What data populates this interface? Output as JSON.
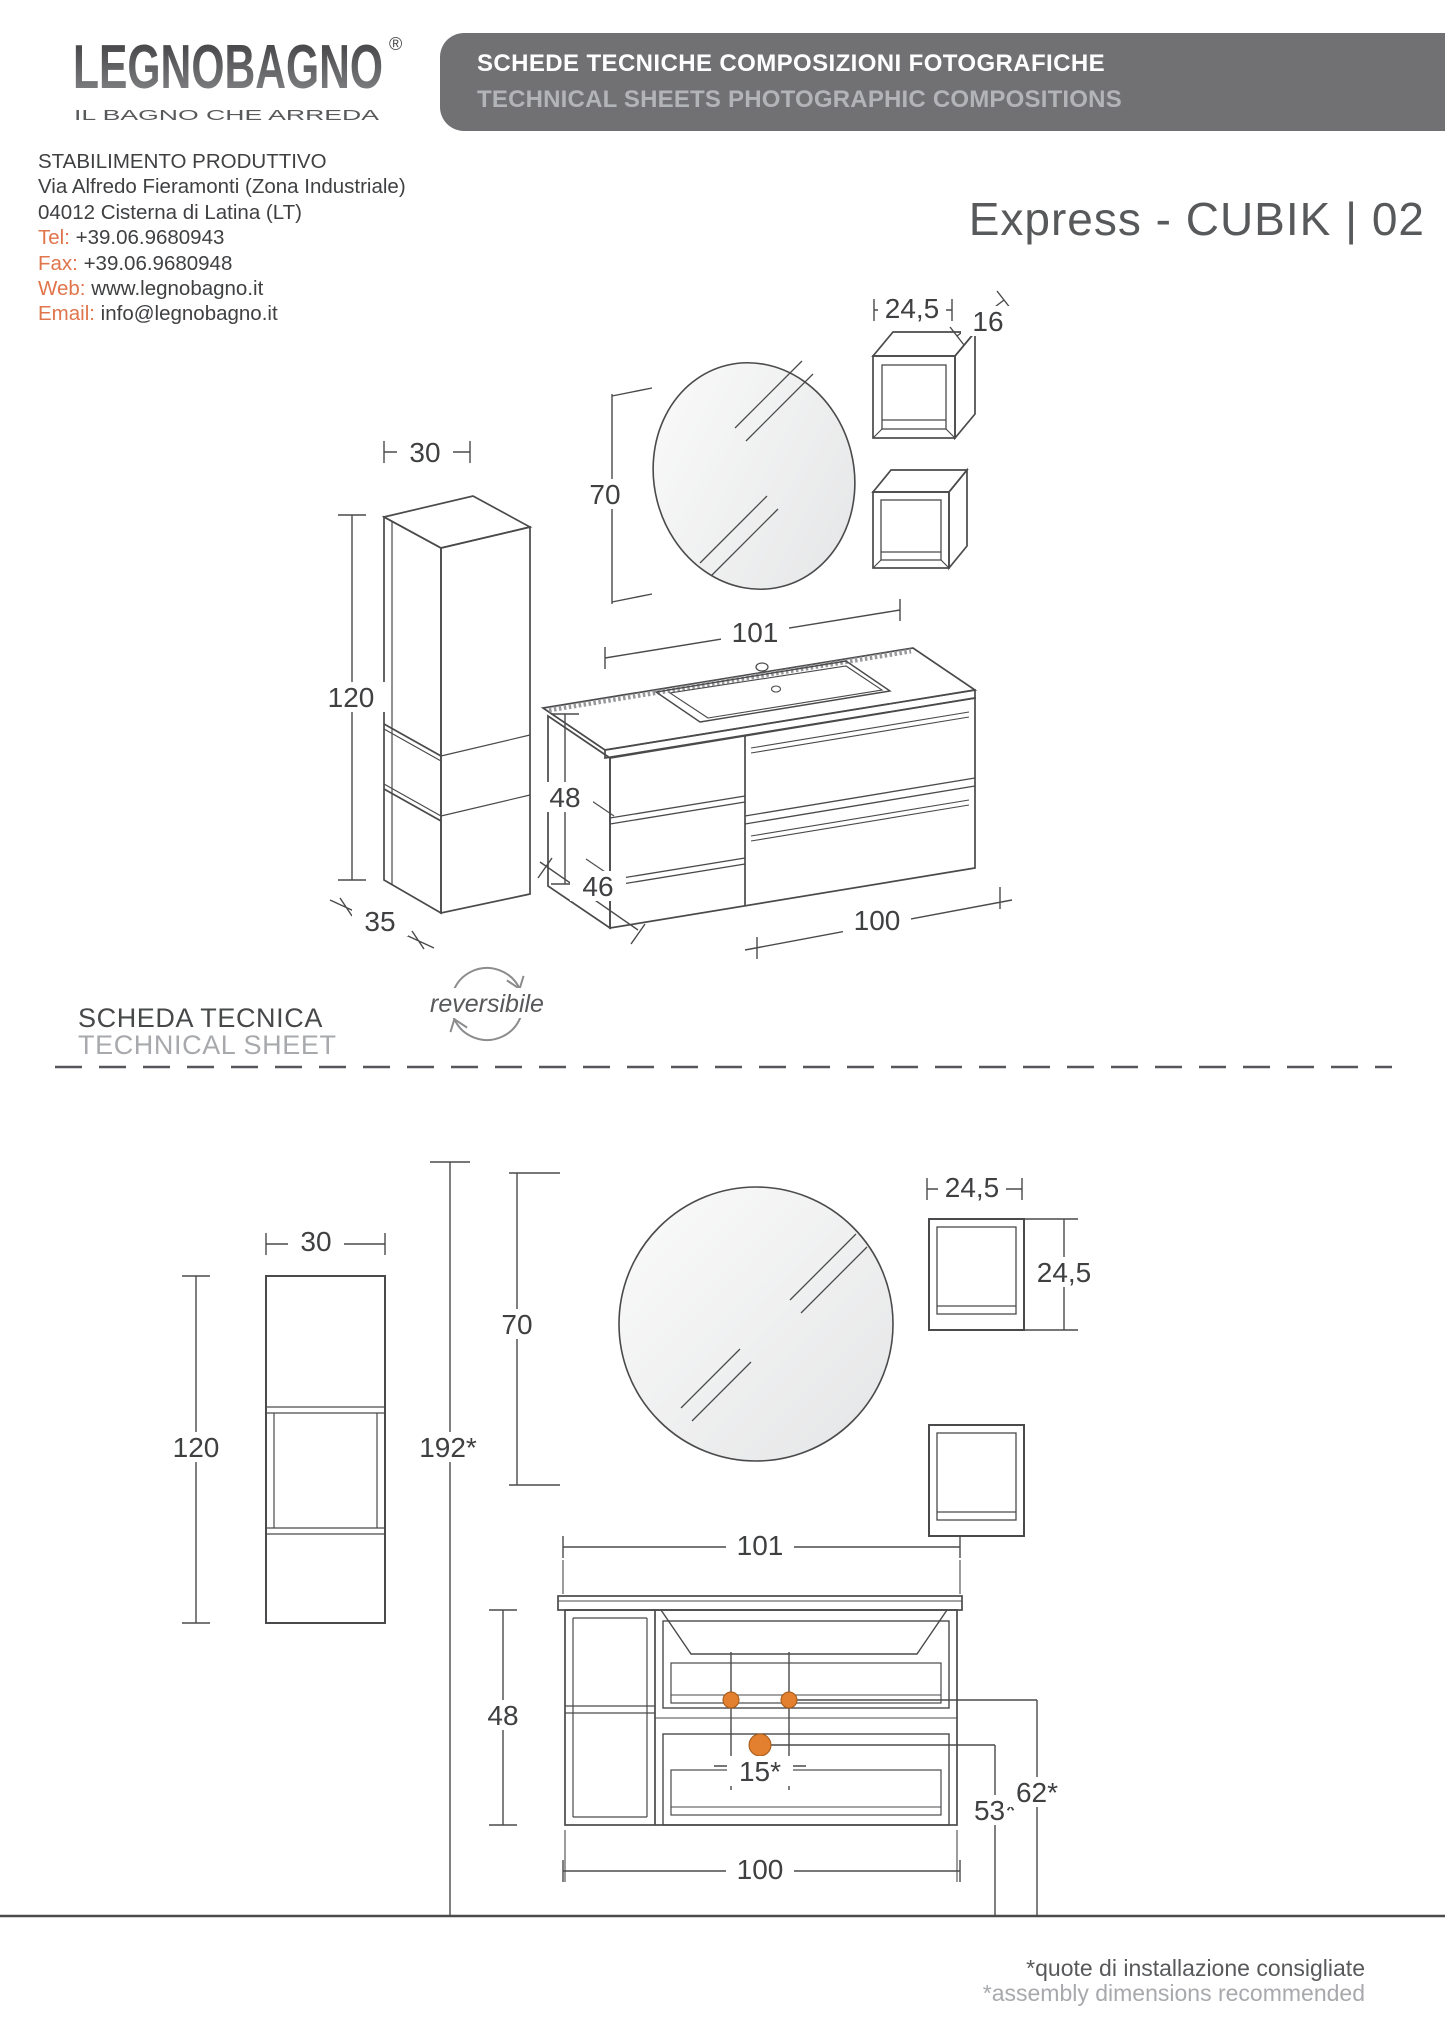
{
  "logo": {
    "brand": "LEGNOBAGNO",
    "registered_mark": "®",
    "tagline": "IL BAGNO CHE ARREDA"
  },
  "banner": {
    "title_it": "SCHEDE TECNICHE COMPOSIZIONI FOTOGRAFICHE",
    "title_en": "TECHNICAL SHEETS PHOTOGRAPHIC COMPOSITIONS"
  },
  "document": {
    "product_title": "Express - CUBIK | 02"
  },
  "contact": {
    "heading": "STABILIMENTO PRODUTTIVO",
    "address_line1": "Via Alfredo Fieramonti (Zona Industriale)",
    "address_line2": "04012 Cisterna di Latina (LT)",
    "tel_label": "Tel:",
    "tel_value": "+39.06.9680943",
    "fax_label": "Fax:",
    "fax_value": "+39.06.9680948",
    "web_label": "Web:",
    "web_value": "www.legnobagno.it",
    "email_label": "Email:",
    "email_value": "info@legnobagno.it"
  },
  "sheet": {
    "label_it": "SCHEDA TECNICA",
    "label_en": "TECHNICAL SHEET",
    "reversible_label": "reversibile",
    "reversible_icon": "circular-arrows-icon"
  },
  "perspective_view": {
    "column_width": "30",
    "column_height": "120",
    "column_depth": "35",
    "mirror_height": "70",
    "cube_width": "24,5",
    "cube_depth": "16",
    "vanity_top_width": "101",
    "vanity_height": "48",
    "vanity_depth": "46",
    "vanity_body_width": "100"
  },
  "front_view": {
    "column_width": "30",
    "column_height": "120",
    "total_height": "192*",
    "mirror_height": "70",
    "cube_width": "24,5",
    "cube_height": "24,5",
    "vanity_top_width": "101",
    "vanity_height": "48",
    "drain_spacing": "15*",
    "vanity_body_width": "100",
    "drain_height": "53*",
    "connection_height": "62*"
  },
  "footnote": {
    "line_it": "*quote di installazione consigliate",
    "line_en": "*assembly dimensions recommended"
  },
  "colors": {
    "accent_orange": "#E0744A",
    "banner_gray": "#717174",
    "line_dark": "#4A4A4C",
    "muted_gray": "#A7A9AC",
    "plumbing_dot_orange": "#E2802F"
  }
}
